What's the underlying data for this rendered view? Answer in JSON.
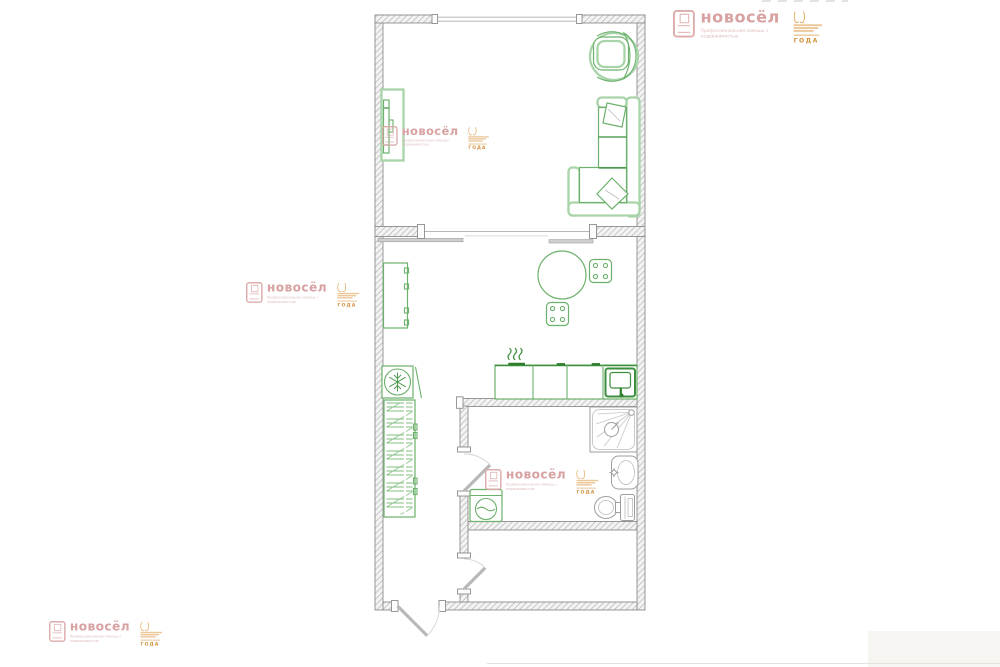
{
  "watermark": {
    "brand": "новосёл",
    "tagline": "Профессиональная помощь с недвижимостью",
    "badge_year": "ГОДА",
    "colors": {
      "pink": "#d8a2a2",
      "orange": "#d2913d"
    }
  },
  "floorplan": {
    "colors": {
      "wall": "#8d8d8d",
      "furniture_green": "#3e8e3e",
      "furniture_light_green": "#a9d4a9",
      "fixture_gray": "#9e9e9e"
    },
    "furniture_icons": [
      "armchair-icon",
      "corner-sofa-icon",
      "pillow-icon",
      "tv-stand-icon",
      "cabinet-icon",
      "dining-table-icon",
      "chair-icon",
      "kitchen-counter-icon",
      "stove-steam-icon",
      "kitchen-sink-icon",
      "refrigerator-icon",
      "wardrobe-icon",
      "washing-machine-icon",
      "shower-icon",
      "washbasin-icon",
      "toilet-icon",
      "window-icon",
      "door-leaf-icon"
    ]
  }
}
